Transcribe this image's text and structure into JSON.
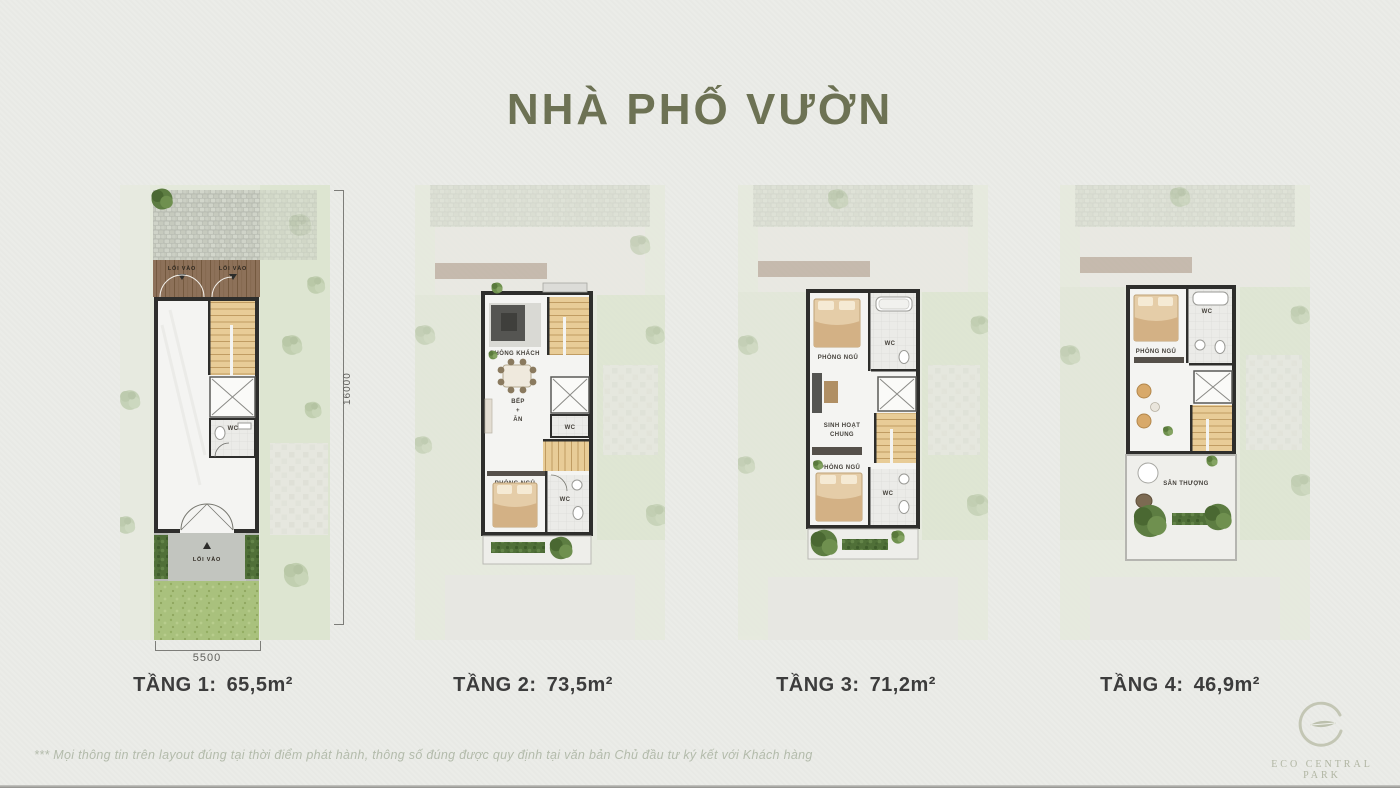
{
  "title": "NHÀ PHỐ VƯỜN",
  "floors": [
    {
      "name": "TẦNG 1:",
      "area": "65,5m²"
    },
    {
      "name": "TẦNG 2:",
      "area": "73,5m²"
    },
    {
      "name": "TẦNG 3:",
      "area": "71,2m²"
    },
    {
      "name": "TẦNG 4:",
      "area": "46,9m²"
    }
  ],
  "dimensions": {
    "lot_width": "5500",
    "lot_depth": "16000"
  },
  "rooms": {
    "entry": "LỐI VÀO",
    "wc": "WC",
    "living": "PHÒNG KHÁCH",
    "kitchen_l1": "BẾP",
    "kitchen_l2": "+",
    "kitchen_l3": "ĂN",
    "bedroom": "PHÒNG NGỦ",
    "common_l1": "SINH HOẠT",
    "common_l2": "CHUNG",
    "terrace": "SÂN THƯỢNG"
  },
  "footer": {
    "note": "*** Mọi thông tin trên layout đúng tại thời điểm phát hành, thông số đúng được quy định tại văn bản Chủ đầu tư ký kết với Khách hàng"
  },
  "logo": {
    "text": "ECO CENTRAL PARK"
  },
  "colors": {
    "title": "#6d7254",
    "caption": "#3c3c3c",
    "wood": "#e6c692",
    "lawn": "#a9c17d"
  }
}
